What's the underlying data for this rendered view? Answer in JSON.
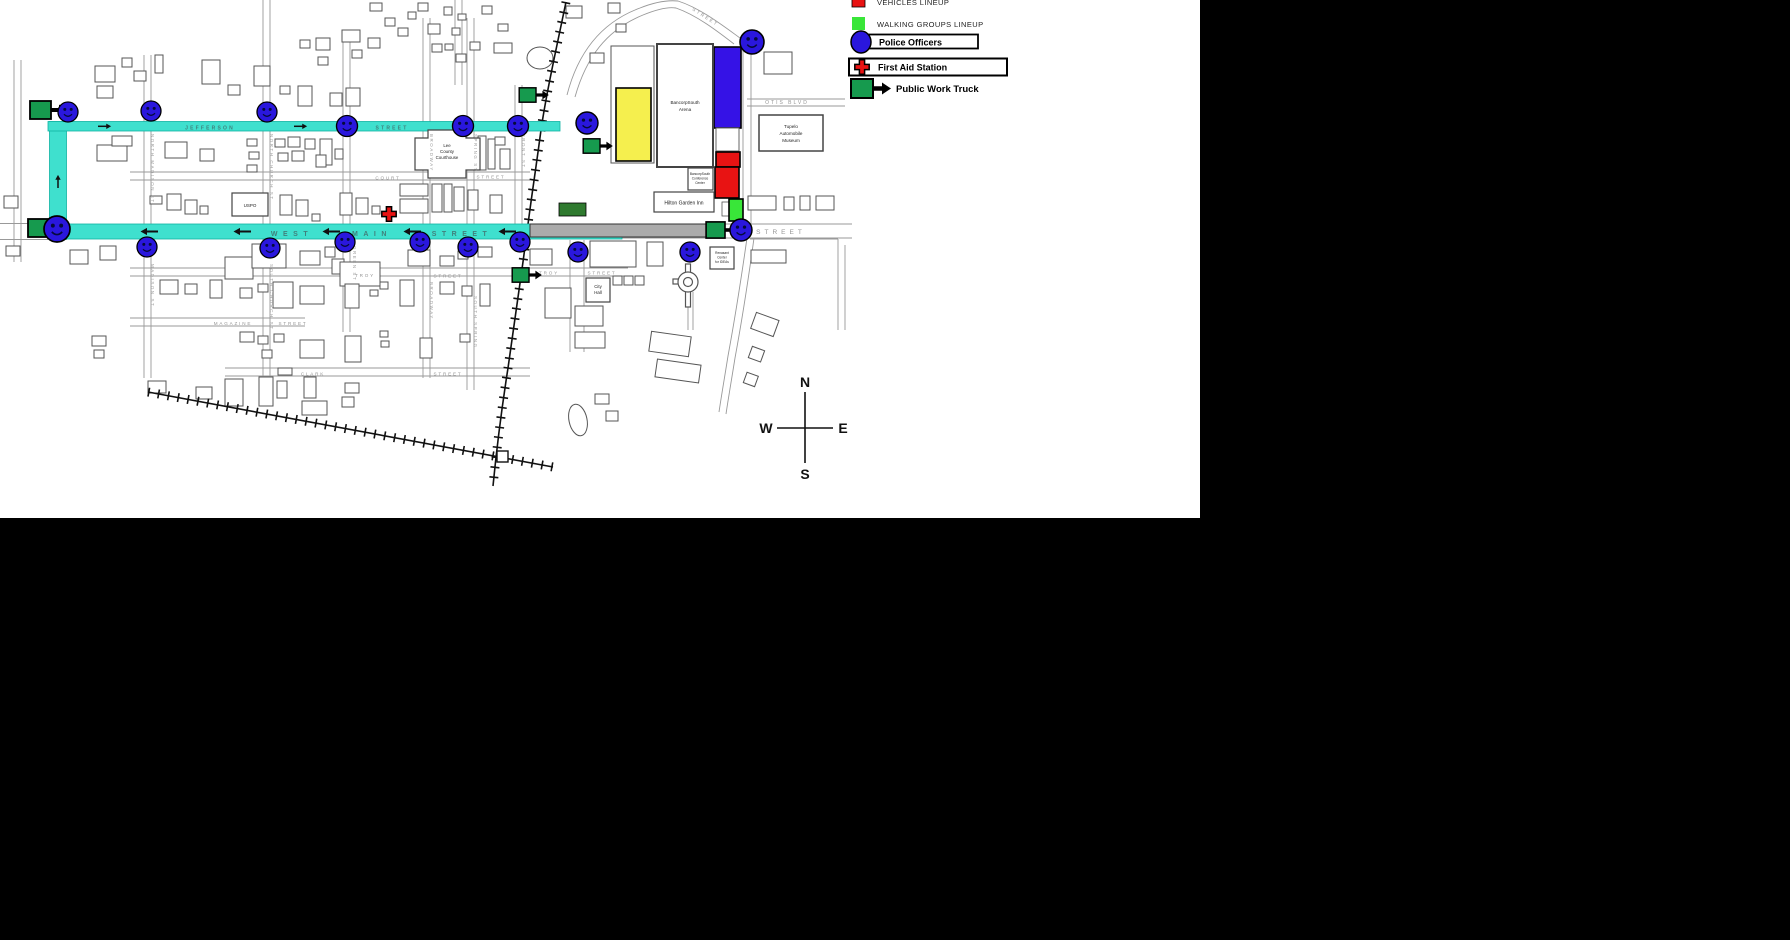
{
  "map": {
    "title": "Downtown parade route map",
    "streets": {
      "jefferson": "JEFFERSON",
      "street": "STREET",
      "west": "WEST",
      "main": "MAIN",
      "court": "COURT",
      "troy": "TROY",
      "magazine": "MAGAZINE",
      "clark": "CLARK",
      "otis_blvd": "OTIS BLVD",
      "north_madison": "NORTH MADISON ST",
      "north_church": "NORTH CHURCH ST",
      "madison": "MADISON ST",
      "south_church": "SOUTH CHURCH ST",
      "broadway": "BROADWAY",
      "spring": "SPRING ST",
      "south_spring": "SOUTH SPRING",
      "front": "FRONT ST",
      "green": "GREEN ST"
    },
    "places": {
      "uspo": "USPO",
      "courthouse": [
        "Lee",
        "County",
        "Courthouse"
      ],
      "arena": [
        "BancorpSouth",
        "Arena"
      ],
      "conference": [
        "BancorpSouth",
        "Conference",
        "Center"
      ],
      "hilton": "Hilton Garden Inn",
      "museum": [
        "Tupelo",
        "Automobile",
        "Museum"
      ],
      "city_hall": [
        "City",
        "Hall"
      ],
      "renasant": [
        "Renasant",
        "Center",
        "for IDEAs"
      ]
    },
    "compass": {
      "n": "N",
      "e": "E",
      "s": "S",
      "w": "W"
    }
  },
  "legend": {
    "items": [
      {
        "label": "VEHICLES LINEUP",
        "color": "#e81313"
      },
      {
        "label": "WALKING GROUPS LINEUP",
        "color": "#39e639"
      },
      {
        "label": "Police Officers",
        "color": "#2a17dd"
      },
      {
        "label": "First Aid Station",
        "color": "#e81313"
      },
      {
        "label": "Public Work Truck",
        "color": "#169a4e"
      }
    ]
  },
  "colors": {
    "route_cyan": "#3fe0ce",
    "police_blue": "#2a17dd",
    "truck_green": "#169a4e",
    "walking_green": "#39e639",
    "vehicles_red": "#e81313",
    "lineup_blue": "#3512e6",
    "lineup_yellow": "#f5ef4e",
    "construction_gray": "#ababab"
  }
}
